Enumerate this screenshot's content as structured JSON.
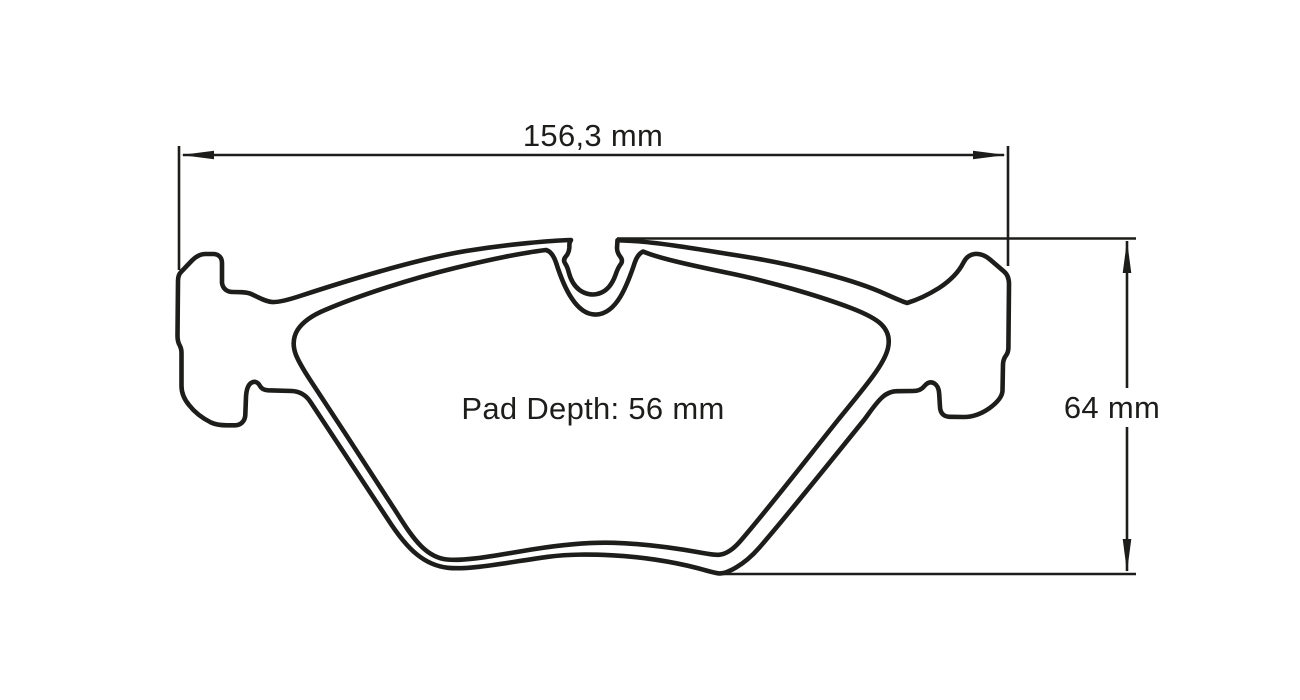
{
  "drawing": {
    "type": "brake-pad-dimensional-drawing",
    "labels": {
      "width_dimension": "156,3 mm",
      "height_dimension": "64 mm",
      "pad_depth": "Pad Depth: 56 mm"
    },
    "colors": {
      "line": "#1d1d1b",
      "background": "#ffffff"
    },
    "icons": {
      "width_left": "arrowhead-left-icon",
      "width_right": "arrowhead-right-icon",
      "height_top": "arrowhead-up-icon",
      "height_bottom": "arrowhead-down-icon"
    }
  }
}
